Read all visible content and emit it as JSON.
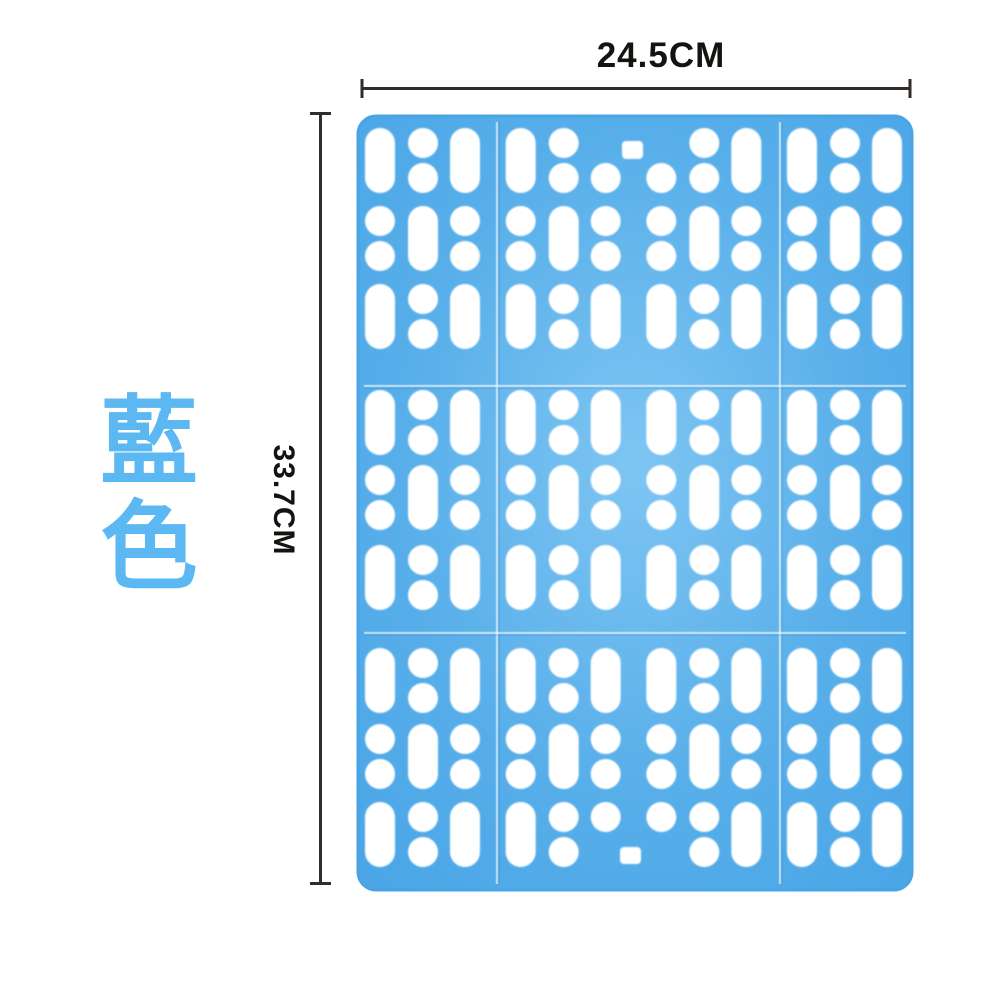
{
  "page": {
    "background": "#ffffff"
  },
  "annotations": {
    "width_label": "24.5CM",
    "height_label": "33.7CM",
    "color_label": "藍色",
    "line_color": "#322d28",
    "label_color": "#151310",
    "color_label_color": "#5cb8f2"
  },
  "mat": {
    "body_color": "#57aee9",
    "body_color_light": "#7ec5f3",
    "edge_color": "#48a4e6",
    "hole_color": "#ffffff",
    "panel_grid": "3x3"
  }
}
